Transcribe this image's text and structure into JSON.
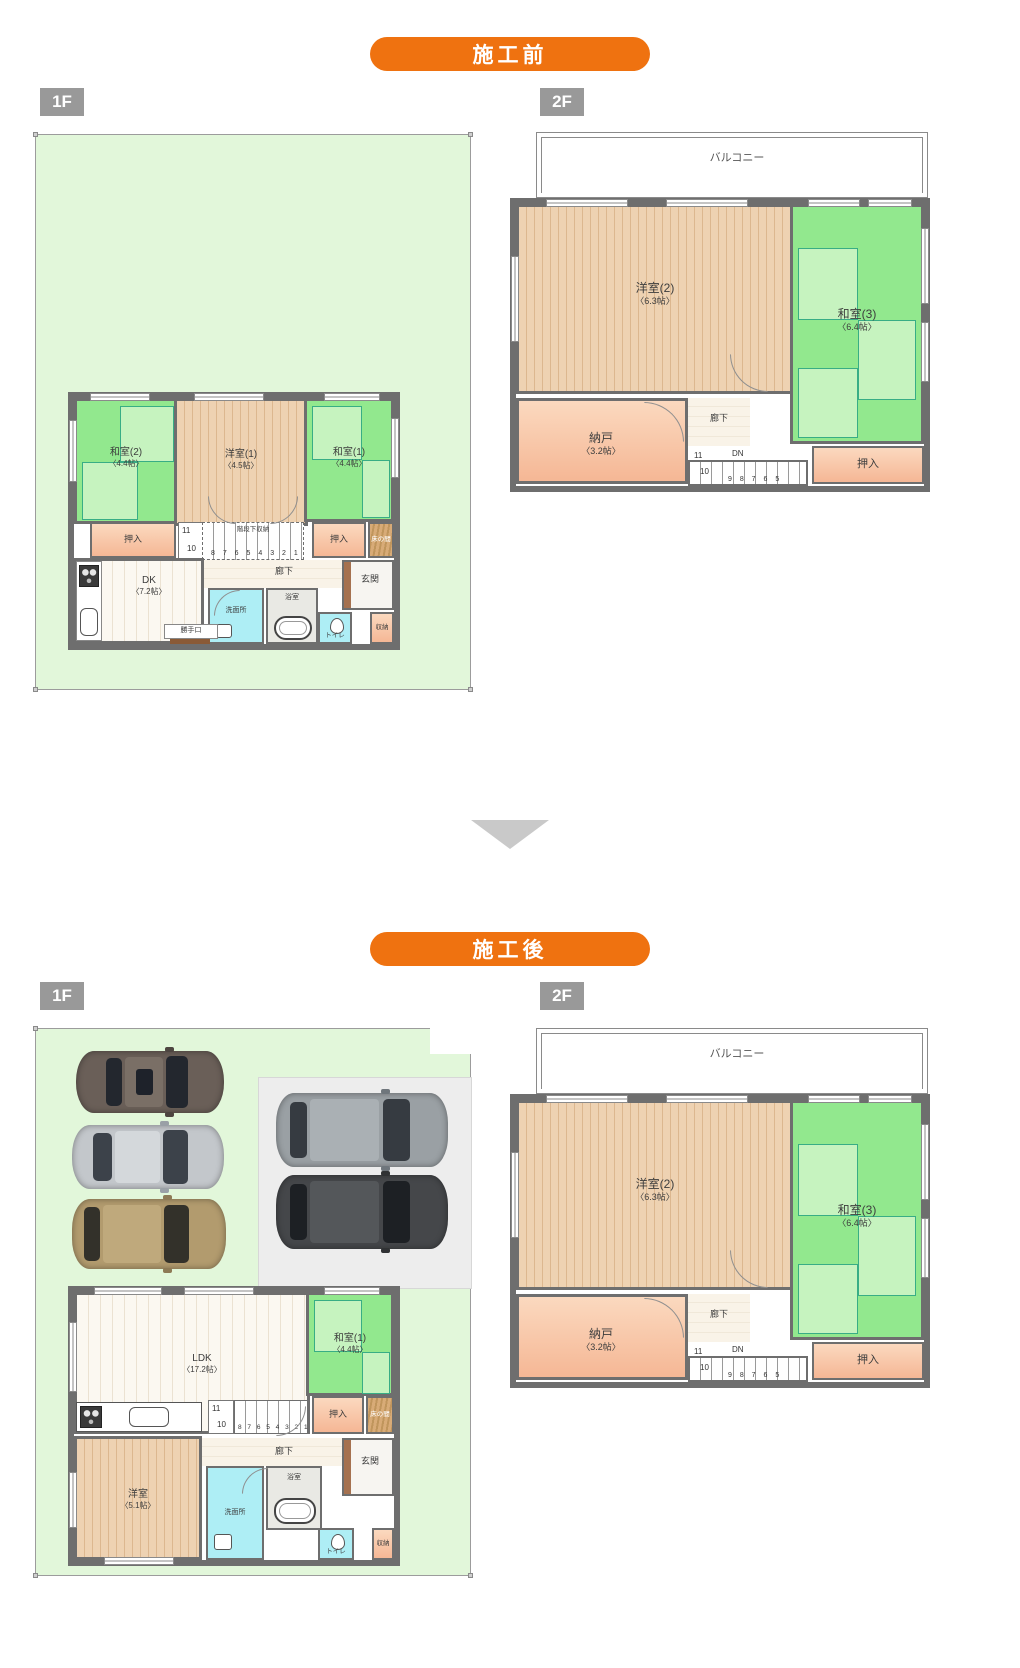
{
  "page": {
    "before_label": "施工前",
    "after_label": "施工後",
    "floor1_label": "1F",
    "floor2_label": "2F"
  },
  "colors": {
    "accent_orange": "#ef7210",
    "floor_badge_gray": "#999999",
    "site_green": "#e2f7da",
    "tatami_green": "#92e88e",
    "wood_tan": "#eccfae",
    "closet_orange": "#f8c8a9",
    "water_cyan": "#aeeef5",
    "wall_gray": "#6e6e6e",
    "arrow_gray": "#c9c9c9"
  },
  "plan_1f_before": {
    "washitsu2": {
      "name": "和室(2)",
      "size": "〈4.4帖〉"
    },
    "yoshitsu1": {
      "name": "洋室(1)",
      "size": "〈4.5帖〉"
    },
    "washitsu1": {
      "name": "和室(1)",
      "size": "〈4.4帖〉"
    },
    "oshiire_left": "押入",
    "oshiire_right": "押入",
    "tokonoma": "床の間",
    "stair_closet": "階段下収納",
    "stair_run": "8 7 6 5 4 3 2 1",
    "stair_n10": "10",
    "stair_n11": "11",
    "dk": {
      "name": "DK",
      "size": "〈7.2帖〉"
    },
    "rouka": "廊下",
    "senmenjo": "洗面所",
    "yokushitsu": "浴室",
    "toire": "トイレ",
    "shuno": "収納",
    "genkan": "玄関",
    "katteguchi": "勝手口"
  },
  "plan_2f": {
    "balcony": "バルコニー",
    "yoshitsu2": {
      "name": "洋室(2)",
      "size": "〈6.3帖〉"
    },
    "washitsu3": {
      "name": "和室(3)",
      "size": "〈6.4帖〉"
    },
    "nando": {
      "name": "納戸",
      "size": "〈3.2帖〉"
    },
    "rouka": "廊下",
    "dn": "DN",
    "stair_n11": "11",
    "stair_n10": "10",
    "stair_run": "9 8 7 6 5",
    "oshiire": "押入"
  },
  "plan_1f_after": {
    "ldk": {
      "name": "LDK",
      "size": "〈17.2帖〉"
    },
    "washitsu1": {
      "name": "和室(1)",
      "size": "〈4.4帖〉"
    },
    "yoshitsu": {
      "name": "洋室",
      "size": "〈5.1帖〉"
    },
    "oshiire": "押入",
    "tokonoma": "床の間",
    "stair_run": "8 7 6 5 4 3 2 1",
    "stair_n10": "10",
    "stair_n11": "11",
    "rouka": "廊下",
    "senmenjo": "洗面所",
    "yokushitsu": "浴室",
    "toire": "トイレ",
    "shuno": "収納",
    "genkan": "玄関"
  }
}
